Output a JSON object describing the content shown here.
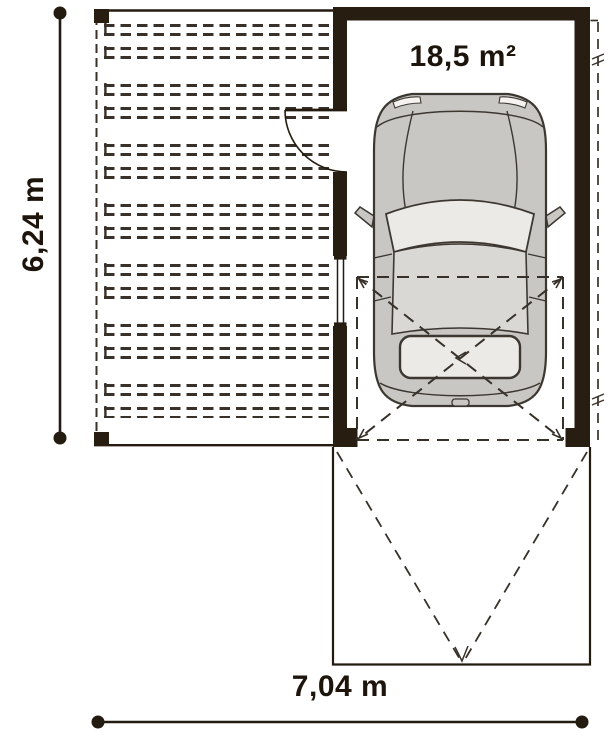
{
  "plan": {
    "garage_area": "18,5 m²",
    "total_width": "7,04 m",
    "total_depth": "6,24 m"
  },
  "colors": {
    "bg": "#ffffff",
    "wall": "#281d11",
    "line": "#241b10",
    "dash": "#38312a",
    "text": "#1d150b",
    "car-body": "#c8c7c4",
    "car-glass": "#eceae6",
    "car-roof": "#d9d8d4",
    "car-line": "#3c3730"
  }
}
